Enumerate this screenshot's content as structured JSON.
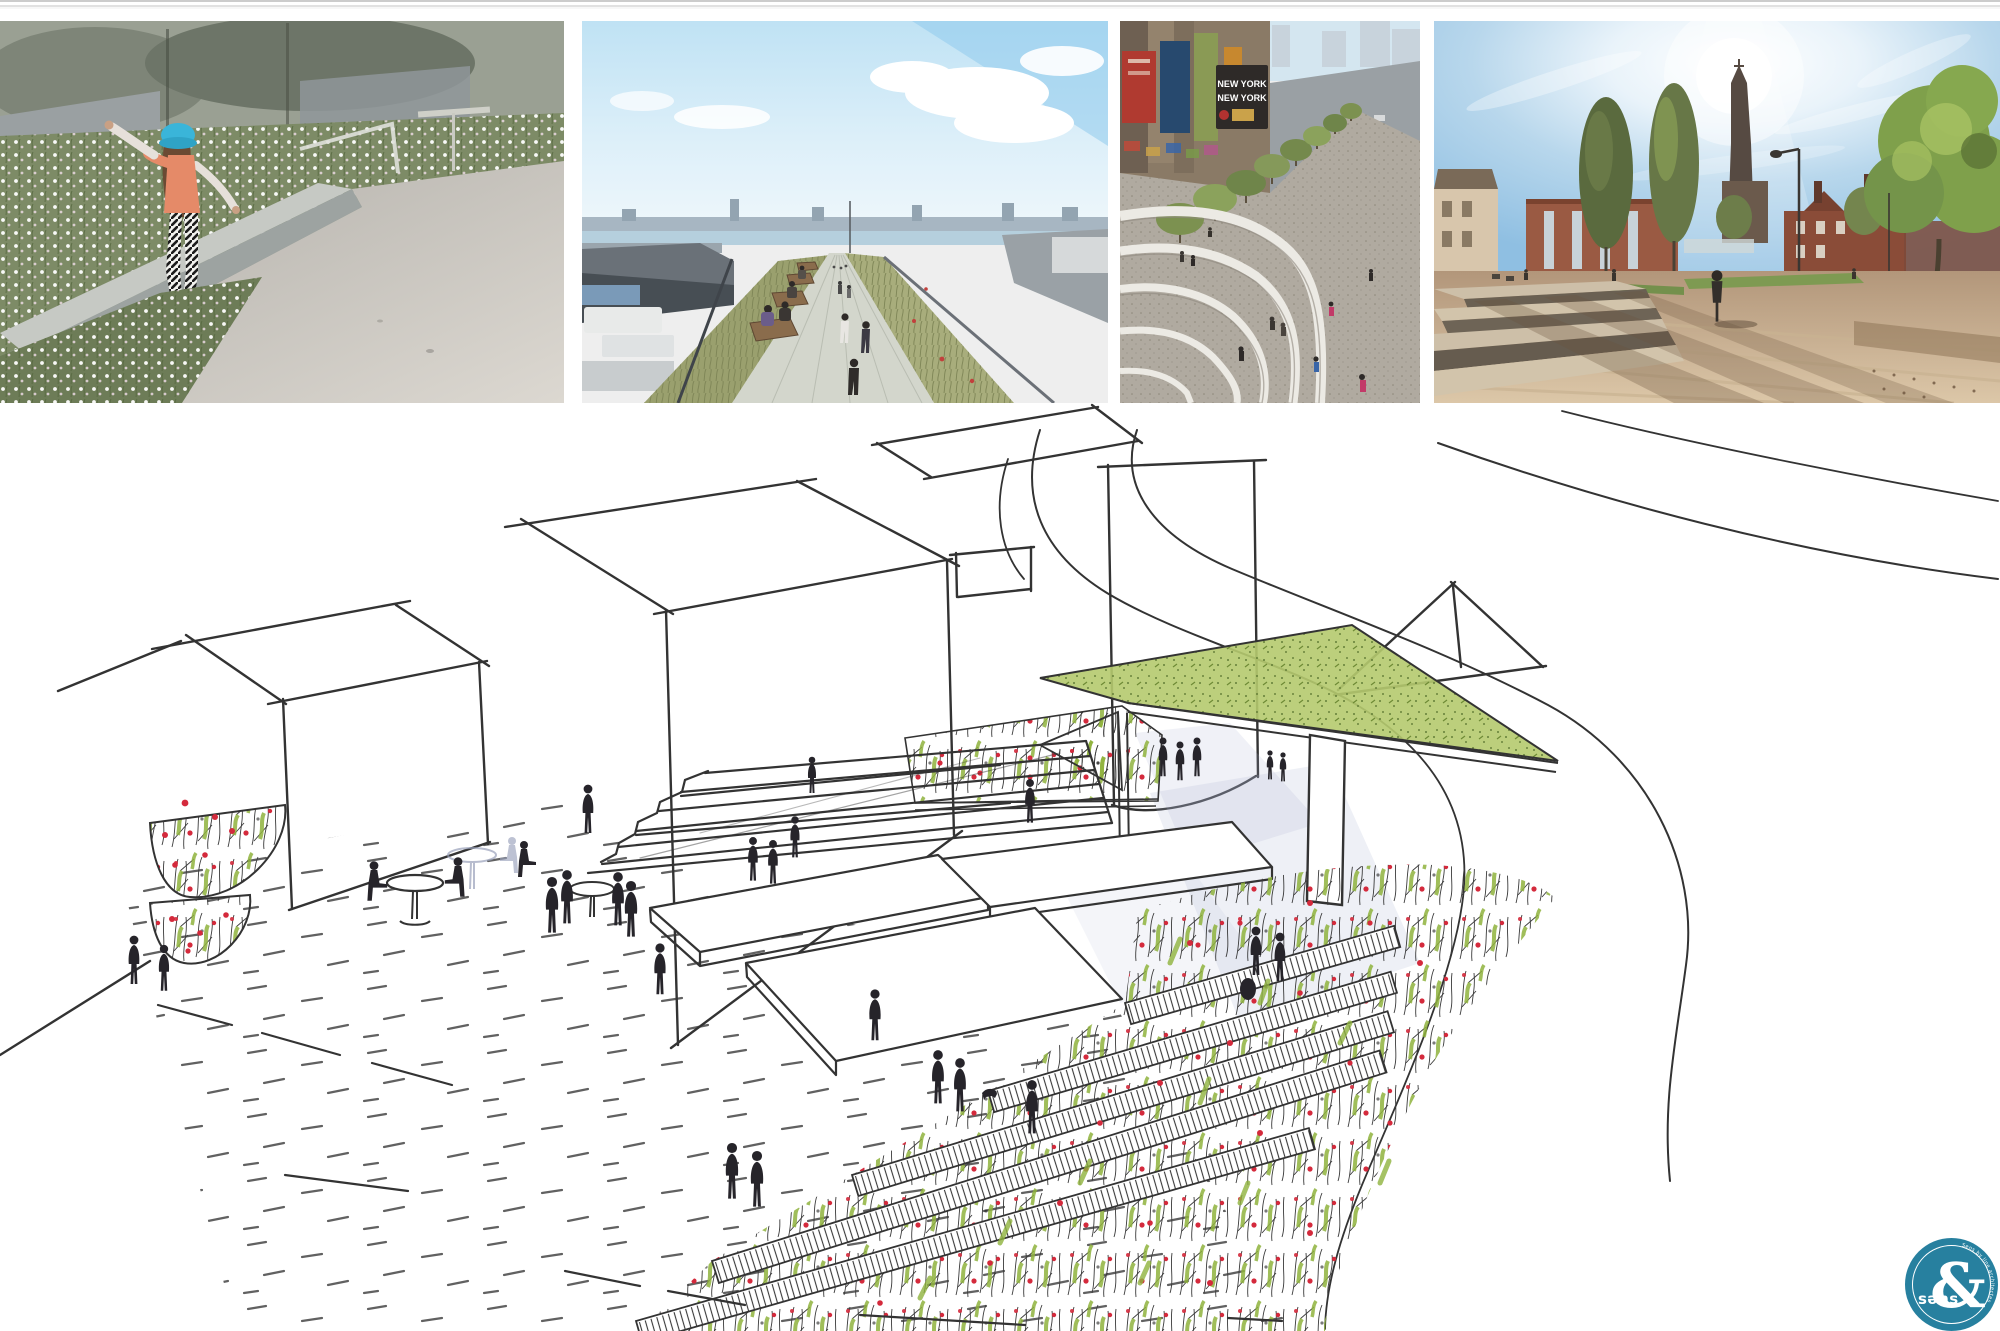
{
  "page": {
    "background": "#ffffff",
    "divider_color": "#cccccc"
  },
  "gallery": {
    "photos": [
      {
        "id": "photo-meadow-child",
        "label": "Child balancing on a planted concrete edge among white wildflowers"
      },
      {
        "id": "photo-high-line",
        "label": "Elevated linear park walkway with benches, grasses and city skyline"
      },
      {
        "id": "photo-stepped-plaza",
        "label": "Aerial view of a stepped plaza promenade with trees",
        "sign_line_1": "NEW YORK",
        "sign_line_2": "NEW YORK"
      },
      {
        "id": "photo-town-square",
        "label": "Sunlit town square with church spire, brick buildings and trees"
      }
    ]
  },
  "sketch": {
    "label": "Hand-drawn perspective sketch of a plaza with terraced wildflower planters, wide steps, canopy structure, cafe tables and people",
    "colors": {
      "ink": "#333333",
      "marker_green": "#8fb33d",
      "marker_green_light": "#b5ca6e",
      "marker_red": "#d42a3c",
      "pencil_blue": "#aab4d4"
    }
  },
  "logo": {
    "background": "#27809f",
    "ampersand": "&",
    "wordmark": "səns",
    "curved_text": "Sens by line architectes"
  }
}
